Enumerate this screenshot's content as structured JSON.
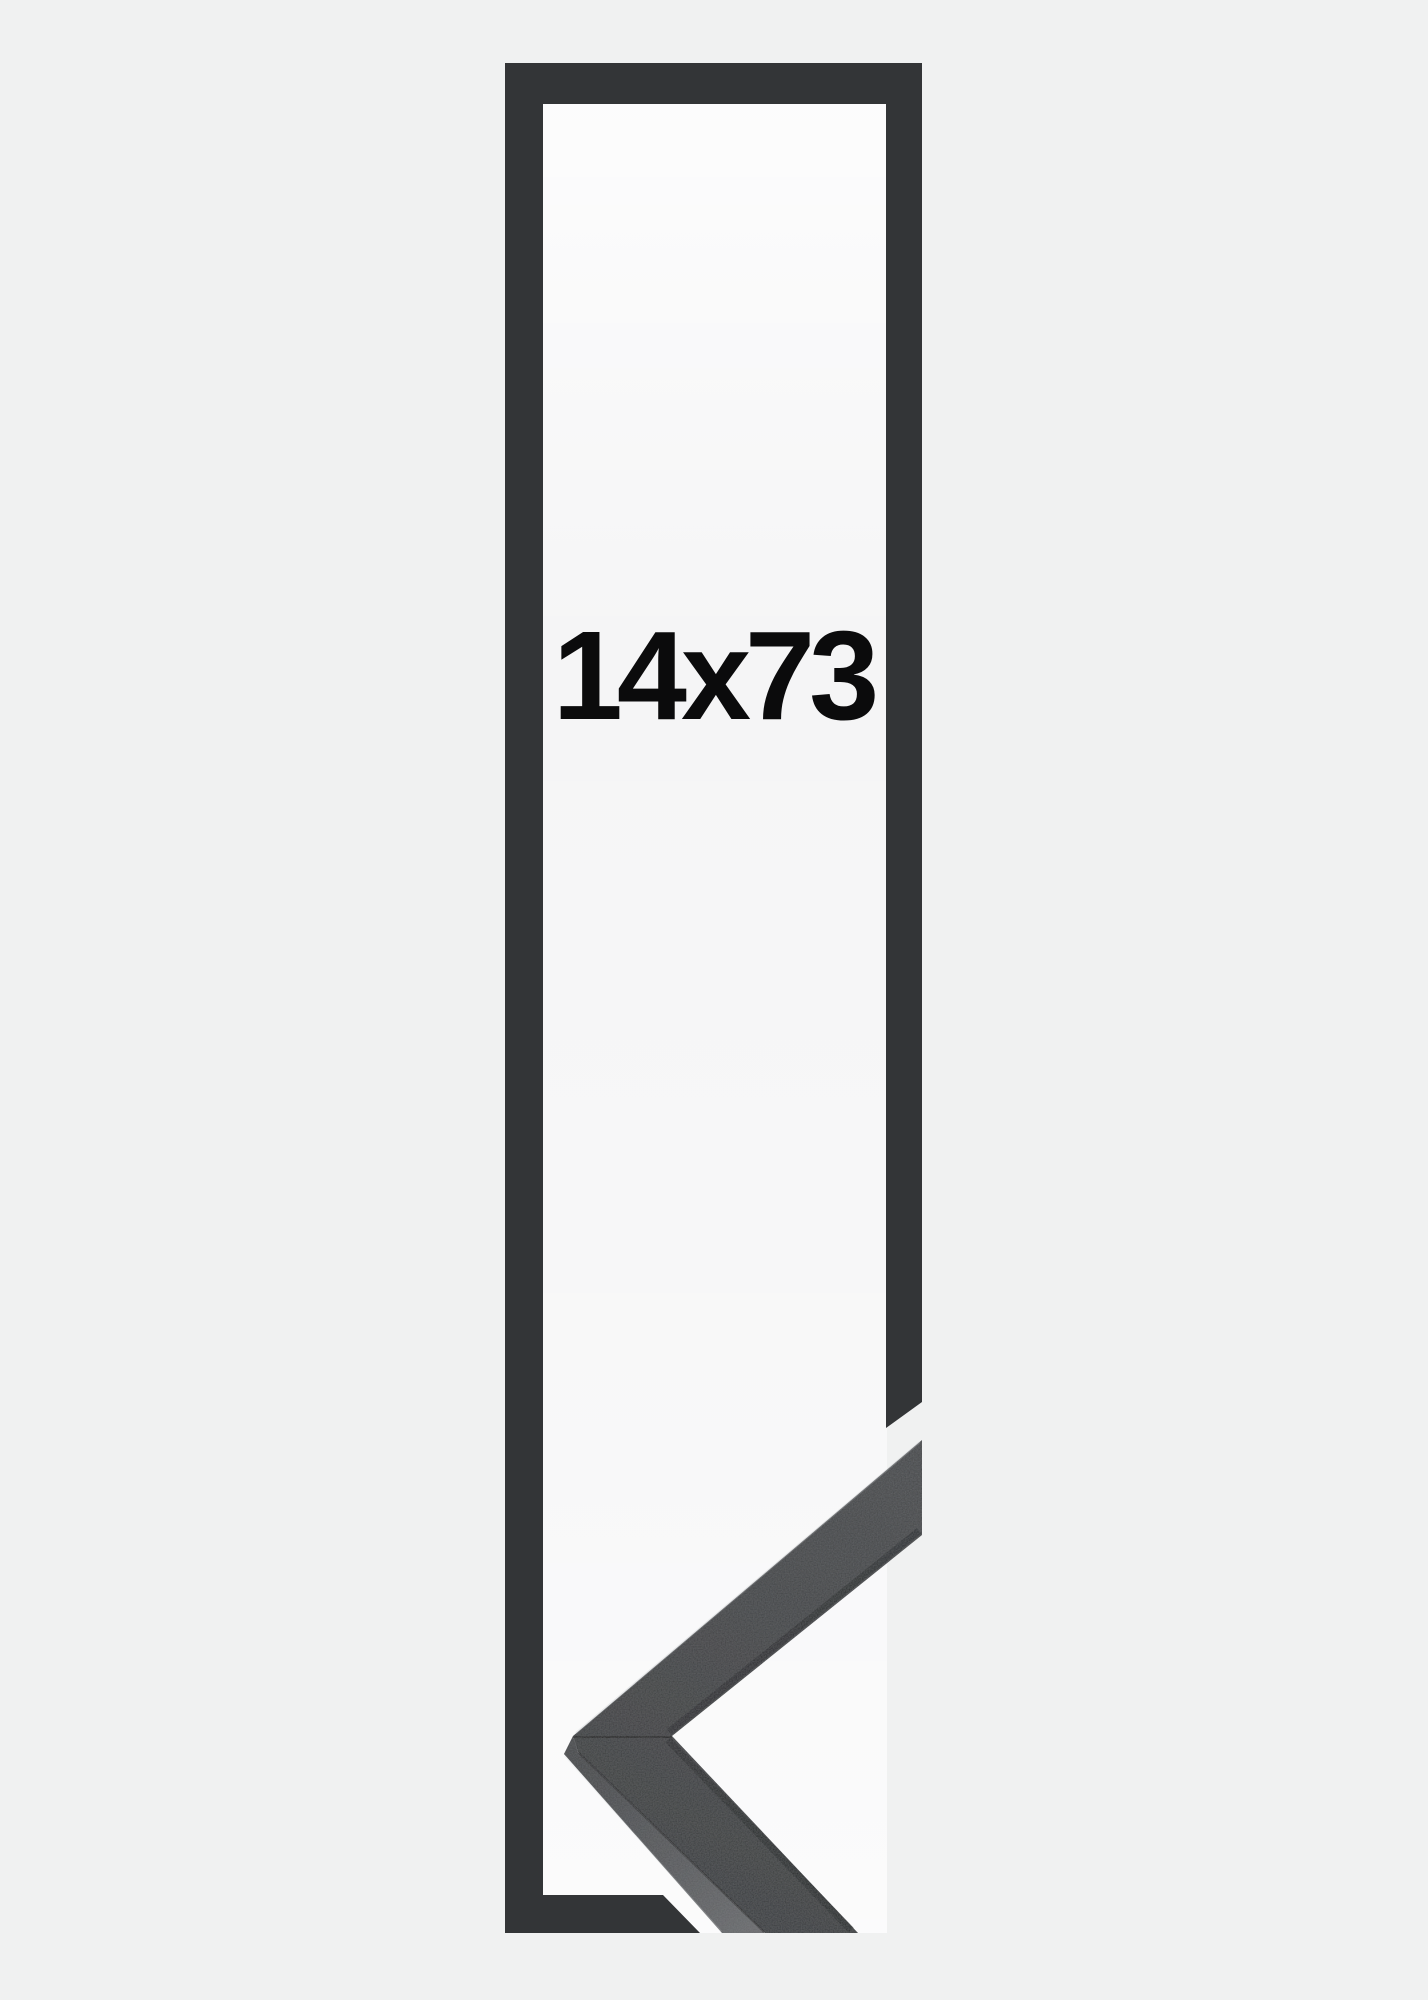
{
  "image": {
    "size_label": "14x73"
  },
  "colors": {
    "background": "#f0f1f1",
    "opening": "#f5f5f6",
    "outline": "#333537",
    "sample_face": "#3b3d3f",
    "sample_side": "#4e5053",
    "sample_lip": "#1a1c1e",
    "label_text": "#0b0b0c"
  }
}
